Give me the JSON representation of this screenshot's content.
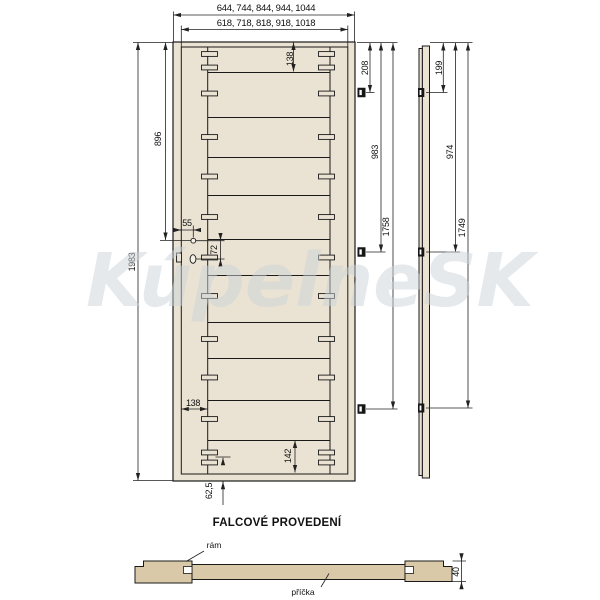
{
  "watermark": "KúpelneSK",
  "title": "FALCOVÉ PROVEDENÍ",
  "front_view": {
    "width_outer_options": "644, 744, 844, 944, 1044",
    "width_inner_options": "618, 718, 818, 918, 1018",
    "height_total": "1983",
    "handle_height": "896",
    "handle_edge_offset": "55",
    "handle_to_lock": "72",
    "top_rail_height": "138",
    "stile_width": "138",
    "bottom_tenon_offset": "62,5",
    "bottom_rail_height": "142",
    "hinge1_from_top": "208",
    "hinge2_from_top": "983",
    "hinge3_from_top": "1758"
  },
  "side_view": {
    "hinge1_from_top": "199",
    "hinge2_from_top": "974",
    "hinge3_from_top": "1749"
  },
  "section_view": {
    "thickness": "40",
    "frame_label": "rám",
    "crossbar_label": "příčka"
  },
  "colors": {
    "door_fill": "#eae2d3",
    "section_fill": "#d9c9a8",
    "line": "#1a1a1a"
  }
}
